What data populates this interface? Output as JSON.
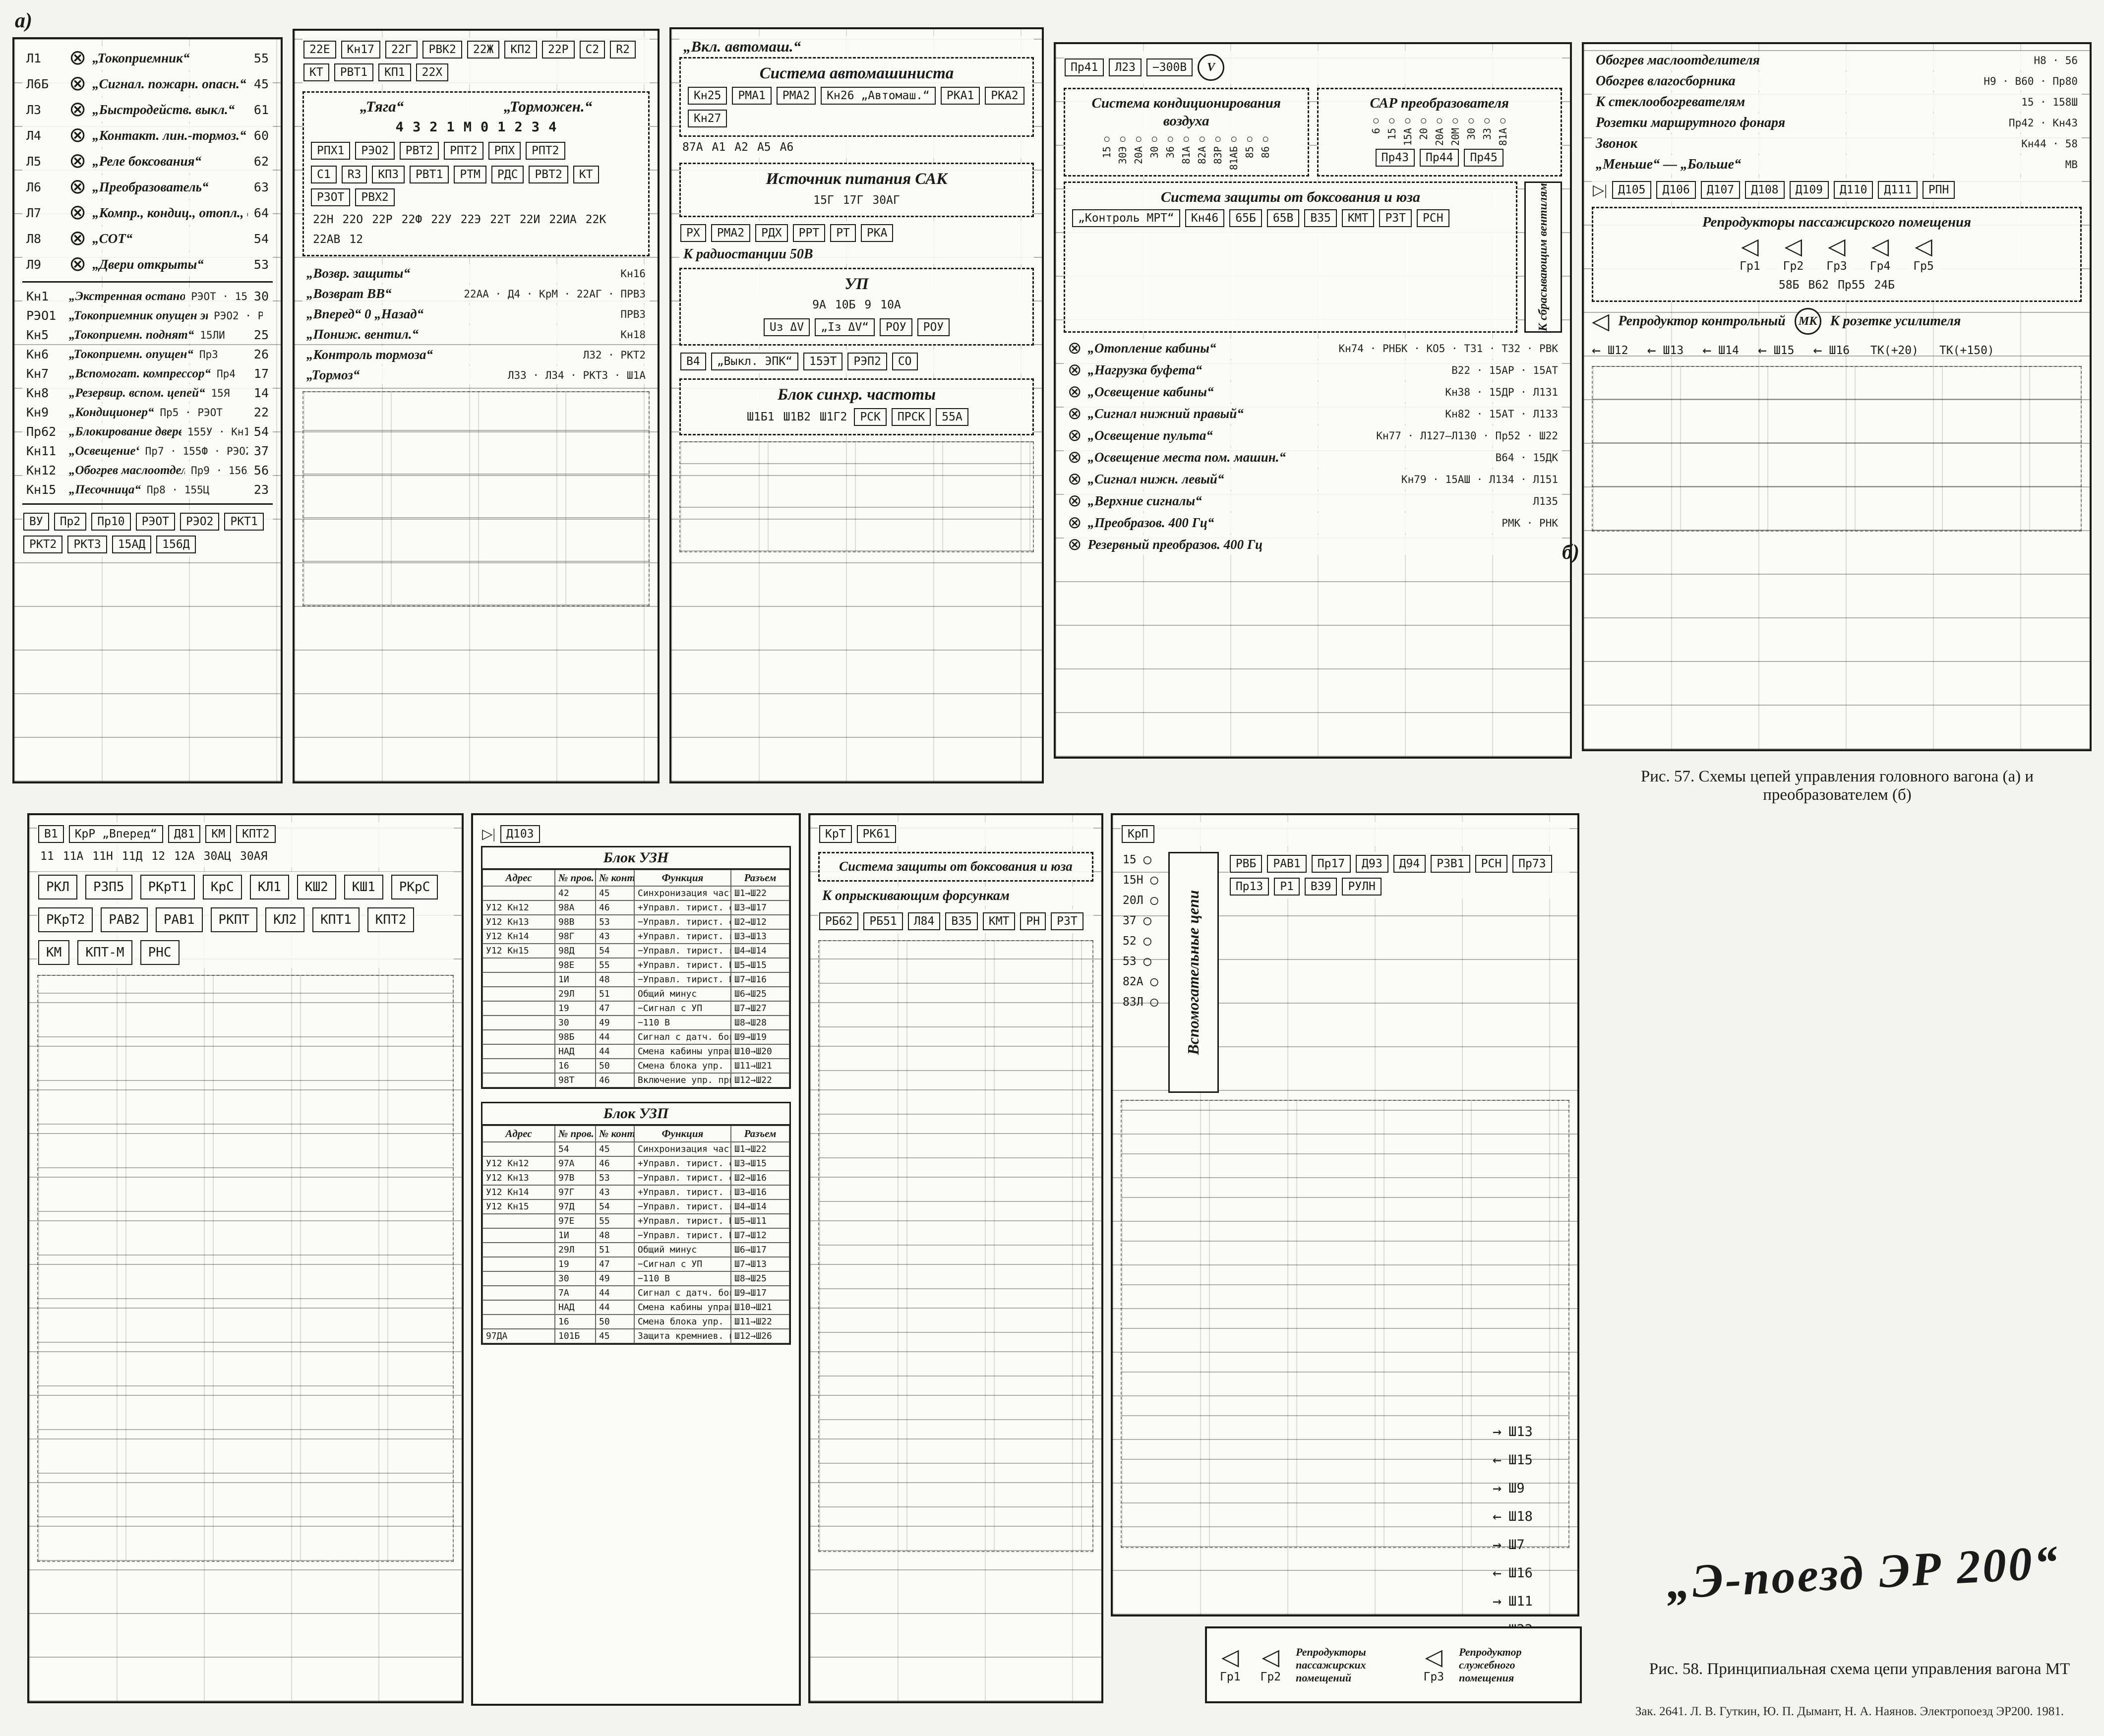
{
  "page": {
    "marker_a": "а)",
    "marker_b": "б)",
    "figure57_caption": "Рис. 57. Схемы цепей управления головного вагона (а) и преобразователем (б)",
    "figure58_caption": "Рис. 58. Принципиальная схема цепи управления вагона МТ",
    "handwriting": "„Э-поезд  ЭР 200“",
    "imprint": "Зак. 2641. Л. В. Гуткин, Ю. П. Дымант, Н. А. Наянов. Электропоезд ЭР200. 1981.",
    "ink_color": "#1a1a1a",
    "paper_color": "#f4f3ed"
  },
  "panelA": {
    "lamps": [
      {
        "id": "Л1",
        "label": "„Токоприемник“",
        "wire": "55"
      },
      {
        "id": "Л6Б",
        "label": "„Сигнал. пожарн. опасн.“",
        "wire": "45"
      },
      {
        "id": "Л3",
        "label": "„Быстродейств. выкл.“",
        "wire": "61"
      },
      {
        "id": "Л4",
        "label": "„Контакт. лин.-тормоз.“",
        "wire": "60"
      },
      {
        "id": "Л5",
        "label": "„Реле боксования“",
        "wire": "62"
      },
      {
        "id": "Л6",
        "label": "„Преобразователь“",
        "wire": "63"
      },
      {
        "id": "Л7",
        "label": "„Компр., кондиц., отопл., вентиляц.“",
        "wire": "64"
      },
      {
        "id": "Л8",
        "label": "„СОТ“",
        "wire": "54"
      },
      {
        "id": "Л9",
        "label": "„Двери открыты“",
        "wire": "53"
      }
    ],
    "switches": [
      {
        "id": "Кн1",
        "label": "„Экстренная остановка“",
        "aux": "РЭОТ · 15БР",
        "wire": "30"
      },
      {
        "id": "РЭО1",
        "label": "„Токоприемник опущен экстренно“",
        "aux": "РЭО2 · РЭОТ",
        "wire": ""
      },
      {
        "id": "Кн5",
        "label": "„Токоприемн. поднят“",
        "aux": "15ЛИ",
        "wire": "25"
      },
      {
        "id": "Кн6",
        "label": "„Токоприемн. опущен“",
        "aux": "Пр3",
        "wire": "26"
      },
      {
        "id": "Кн7",
        "label": "„Вспомогат. компрессор“",
        "aux": "Пр4",
        "wire": "17"
      },
      {
        "id": "Кн8",
        "label": "„Резервир. вспом. цепей“",
        "aux": "15Я",
        "wire": "14"
      },
      {
        "id": "Кн9",
        "label": "„Кондиционер“",
        "aux": "Пр5 · РЭОТ",
        "wire": "22"
      },
      {
        "id": "Пр62",
        "label": "„Блокирование дверей“",
        "aux": "155У · Кн10",
        "wire": "54"
      },
      {
        "id": "Кн11",
        "label": "„Освещение“",
        "aux": "Пр7 · 155Ф · РЭО2",
        "wire": "37"
      },
      {
        "id": "Кн12",
        "label": "„Обогрев маслоотдел.“",
        "aux": "Пр9 · 156Х",
        "wire": "56"
      },
      {
        "id": "Кн15",
        "label": "„Песочница“",
        "aux": "Пр8 · 155Ц",
        "wire": "23"
      }
    ],
    "bottom_components": [
      "ВУ",
      "Пр2",
      "Пр10",
      "РЭОТ",
      "РЭО2",
      "РКТ1",
      "РКТ2",
      "РКТ3",
      "15АД",
      "156Д"
    ]
  },
  "panelB": {
    "top_components": [
      "22Е",
      "Кн17",
      "22Г",
      "РВК2",
      "22Ж",
      "КП2",
      "22Р",
      "С2",
      "R2",
      "КТ",
      "РВТ1",
      "КП1",
      "22Х"
    ],
    "controller": {
      "left_title": "„Тяга“",
      "right_title": "„Торможен.“",
      "positions": [
        "4",
        "3",
        "2",
        "1",
        "М",
        "0",
        "1",
        "2",
        "3",
        "4"
      ],
      "left_contacts": [
        "РПХ1",
        "РЭО2",
        "РВТ2",
        "РПТ2",
        "РПХ",
        "РПТ2"
      ],
      "right_components": [
        "С1",
        "R3",
        "КП3",
        "РВТ1",
        "РТМ",
        "РДС",
        "РВТ2",
        "КТ",
        "РЗОТ",
        "РВХ2"
      ],
      "wires": [
        "22Н",
        "22О",
        "22Р",
        "22Ф",
        "22У",
        "22Э",
        "22Т",
        "22И",
        "22ИА",
        "22К",
        "22АВ",
        "12"
      ]
    },
    "rows": [
      {
        "label": "„Возвр. защиты“",
        "parts": "Кн16"
      },
      {
        "label": "„Возврат ВВ“",
        "parts": "22АА · Д4 · КрМ · 22АГ · ПРВ3"
      },
      {
        "label": "„Вперед“ 0 „Назад“",
        "parts": "ПРВ3"
      },
      {
        "label": "„Пониж. вентил.“",
        "parts": "Кн18"
      },
      {
        "label": "„Контроль тормоза“",
        "parts": "Л32 · РКТ2"
      },
      {
        "label": "„Тормоз“",
        "parts": "Л33 · Л34 · РКТ3 · Ш1А"
      }
    ]
  },
  "panelC": {
    "inlet": "„Вкл. автомаш.“",
    "box_title": "Система автомашиниста",
    "components": [
      "Кн25",
      "РМА1",
      "РМА2",
      "Кн26 „Автомаш.“",
      "РКА1",
      "РКА2",
      "Кн27"
    ],
    "wire_tags": [
      "87А",
      "А1",
      "А2",
      "А5",
      "А6"
    ],
    "source_box": "Источник питания САК",
    "source_wires": [
      "15Г",
      "17Г",
      "30АГ"
    ],
    "mid_components": [
      "РХ",
      "РМА2",
      "РДХ",
      "РРТ",
      "РТ",
      "РКА"
    ],
    "radio_note": "К радиостанции 50В",
    "up_box": "УП",
    "up_pins": [
      "9А",
      "10Б",
      "9",
      "10А"
    ],
    "up_labels": [
      "Uз ΔV",
      "„Iз ΔV“",
      "РОУ",
      "РОУ"
    ],
    "bottom_row": [
      "В4",
      "„Выкл. ЭПК“",
      "15ЭТ",
      "РЭП2",
      "СО"
    ],
    "sync_box": "Блок синхр. частоты",
    "sync_ports": [
      "Ш1Б1",
      "Ш1В2",
      "Ш1Г2"
    ],
    "sync_components": [
      "РСК",
      "ПРСК",
      "55А"
    ]
  },
  "panelD": {
    "top_components": [
      "Пр41",
      "Л23",
      "−300В"
    ],
    "cond_box": "Система кондиционирования воздуха",
    "cond_terminals": [
      "15",
      "30Э",
      "20А",
      "30",
      "36",
      "81А",
      "82А",
      "83Р",
      "81АБ",
      "85",
      "86"
    ],
    "sar_box": "САР преобразователя",
    "sar_terminals": [
      "6",
      "15",
      "15А",
      "20",
      "20А",
      "20М",
      "30",
      "33",
      "81А"
    ],
    "fuses": [
      "Пр43",
      "Пр44",
      "Пр45"
    ],
    "protect_box": "Система защиты от боксования и юза",
    "protect_note": "К сбрасывающим вентилям",
    "protect_components": [
      "„Контроль МРТ“",
      "Кн46",
      "65Б",
      "65В",
      "В35",
      "КМТ",
      "РЗТ",
      "РСН"
    ],
    "light_rows": [
      {
        "label": "„Отопление кабины“",
        "parts": "Кн74 · РНБК · КО5 · Т31 · Т32 · РВК"
      },
      {
        "label": "„Нагрузка буфета“",
        "parts": "В22 · 15АР · 15АТ"
      },
      {
        "label": "„Освещение кабины“",
        "parts": "Кн38 · 15ДР · Л131"
      },
      {
        "label": "„Сигнал нижний правый“",
        "parts": "Кн82 · 15АТ · Л133"
      },
      {
        "label": "„Освещение пульта“",
        "parts": "Кн77 · Л127–Л130 · Пр52 · Ш22"
      },
      {
        "label": "„Освещение места пом. машин.“",
        "parts": "В64 · 15ДК"
      },
      {
        "label": "„Сигнал нижн. левый“",
        "parts": "Кн79 · 15АШ · Л134 · Л151"
      },
      {
        "label": "„Верхние сигналы“",
        "parts": "Л135"
      },
      {
        "label": "„Преобразов. 400 Гц“",
        "parts": "РМК · РНК"
      },
      {
        "label": "Резервный преобразов. 400 Гц",
        "parts": ""
      }
    ]
  },
  "panelE": {
    "rows1": [
      {
        "label": "Обогрев маслоотделителя",
        "parts": "Н8 · 56"
      },
      {
        "label": "Обогрев влагосборника",
        "parts": "Н9 · В60 · Пр80"
      },
      {
        "label": "К стеклообогревателям",
        "parts": "15 · 158Ш"
      },
      {
        "label": "Розетки маршрутного фонаря",
        "parts": "Пр42 · Кн43"
      },
      {
        "label": "Звонок",
        "parts": "Кн44 · 58"
      },
      {
        "label": "„Меньше“ — „Больше“",
        "parts": "МВ"
      }
    ],
    "diodes": [
      "Д105",
      "Д106",
      "Д107",
      "Д108",
      "Д109",
      "Д110",
      "Д111",
      "РПН"
    ],
    "speakers_title": "Репродукторы пассажирского помещения",
    "speakers": [
      "Гр1",
      "Гр2",
      "Гр3",
      "Гр4",
      "Гр5"
    ],
    "speaker_parts": [
      "58Б",
      "В62",
      "Пр55",
      "24Б"
    ],
    "monitor_title": "Репродуктор контрольный",
    "mic": "МК",
    "amp_note": "К розетке усилителя",
    "sh_tags": [
      "Ш12",
      "Ш13",
      "Ш14",
      "Ш15",
      "Ш16"
    ],
    "tk_tags": [
      "ТК(+20)",
      "ТК(+150)"
    ]
  },
  "panelF": {
    "header": [
      "В1",
      "КрР „Вперед“",
      "Д81",
      "КМ",
      "КПТ2"
    ],
    "wires": [
      "11",
      "11А",
      "11Н",
      "11Д",
      "12",
      "12А",
      "30АЦ",
      "30АЯ"
    ],
    "components": [
      "РКЛ",
      "РЗП5",
      "РКрТ1",
      "КрС",
      "КЛ1",
      "КШ2",
      "КШ1",
      "РКрС",
      "РКрТ2",
      "РАВ2",
      "РАВ1",
      "РКПТ",
      "КЛ2",
      "КПТ1",
      "КПТ2",
      "КМ",
      "КПТ-М",
      "РНС"
    ]
  },
  "panelG": {
    "top_components": [
      "Д103"
    ],
    "columns": [
      "Адрес",
      "№ пров.",
      "№ конт.",
      "Функция",
      "Разъем"
    ],
    "table1_title": "Блок УЗН",
    "rows1": [
      {
        "a": "",
        "p": "42",
        "k": "45",
        "f": "Синхронизация частоты",
        "r": "Ш1→Ш22"
      },
      {
        "a": "У12 Кн12",
        "p": "98А",
        "k": "46",
        "f": "+Управл. тирист. отпир.",
        "r": "Ш3→Ш17"
      },
      {
        "a": "У12 Кн13",
        "p": "98В",
        "k": "53",
        "f": "−Управл. тирист. отпир.",
        "r": "Ш2→Ш12"
      },
      {
        "a": "У12 Кн14",
        "p": "98Г",
        "k": "43",
        "f": "+Управл. тирист. гаш.",
        "r": "Ш3→Ш13"
      },
      {
        "a": "У12 Кн15",
        "p": "98Д",
        "k": "54",
        "f": "−Управл. тирист. гаш.",
        "r": "Ш4→Ш14"
      },
      {
        "a": "",
        "p": "98Е",
        "k": "55",
        "f": "+Управл. тирист. КрБ",
        "r": "Ш5→Ш15"
      },
      {
        "a": "",
        "p": "1И",
        "k": "48",
        "f": "−Управл. тирист. КрБ",
        "r": "Ш7→Ш16"
      },
      {
        "a": "",
        "p": "29Л",
        "k": "51",
        "f": "Общий минус",
        "r": "Ш6→Ш25"
      },
      {
        "a": "",
        "p": "19",
        "k": "47",
        "f": "−Сигнал с УП",
        "r": "Ш7→Ш27"
      },
      {
        "a": "",
        "p": "30",
        "k": "49",
        "f": "−110 В",
        "r": "Ш8→Ш28"
      },
      {
        "a": "",
        "p": "98Б",
        "k": "44",
        "f": "Сигнал с датч. боксов.",
        "r": "Ш9→Ш19"
      },
      {
        "a": "",
        "p": "НАД",
        "k": "44",
        "f": "Смена кабины управл.",
        "r": "Ш10→Ш20"
      },
      {
        "a": "",
        "p": "16",
        "k": "50",
        "f": "Смена блока упр. (рез.)",
        "r": "Ш11→Ш21"
      },
      {
        "a": "",
        "p": "98Т",
        "k": "46",
        "f": "Включение упр. приборов",
        "r": "Ш12→Ш22"
      }
    ],
    "table2_title": "Блок УЗП",
    "rows2": [
      {
        "a": "",
        "p": "54",
        "k": "45",
        "f": "Синхронизация частоты",
        "r": "Ш1→Ш22"
      },
      {
        "a": "У12 Кн12",
        "p": "97А",
        "k": "46",
        "f": "+Управл. тирист. отпир.",
        "r": "Ш3→Ш15"
      },
      {
        "a": "У12 Кн13",
        "p": "97В",
        "k": "53",
        "f": "−Управл. тирист. отпир.",
        "r": "Ш2→Ш16"
      },
      {
        "a": "У12 Кн14",
        "p": "97Г",
        "k": "43",
        "f": "+Управл. тирист. гаш.",
        "r": "Ш3→Ш16"
      },
      {
        "a": "У12 Кн15",
        "p": "97Д",
        "k": "54",
        "f": "−Управл. тирист. гаш.",
        "r": "Ш4→Ш14"
      },
      {
        "a": "",
        "p": "97Е",
        "k": "55",
        "f": "+Управл. тирист. КрБ",
        "r": "Ш5→Ш11"
      },
      {
        "a": "",
        "p": "1И",
        "k": "48",
        "f": "−Управл. тирист. КрБ",
        "r": "Ш7→Ш12"
      },
      {
        "a": "",
        "p": "29Л",
        "k": "51",
        "f": "Общий минус",
        "r": "Ш6→Ш17"
      },
      {
        "a": "",
        "p": "19",
        "k": "47",
        "f": "−Сигнал с УП",
        "r": "Ш7→Ш13"
      },
      {
        "a": "",
        "p": "30",
        "k": "49",
        "f": "−110 В",
        "r": "Ш8→Ш25"
      },
      {
        "a": "",
        "p": "7А",
        "k": "44",
        "f": "Сигнал с датч. боксов.",
        "r": "Ш9→Ш17"
      },
      {
        "a": "",
        "p": "НАД",
        "k": "44",
        "f": "Смена кабины управл.",
        "r": "Ш10→Ш21"
      },
      {
        "a": "",
        "p": "16",
        "k": "50",
        "f": "Смена блока упр. (рез.)",
        "r": "Ш11→Ш22"
      },
      {
        "a": "97ДА",
        "p": "101Б",
        "k": "45",
        "f": "Защита кремниев. прибор.",
        "r": "Ш12→Ш26"
      }
    ]
  },
  "panelH": {
    "top": [
      "КрТ",
      "РК61"
    ],
    "box": "Система защиты от боксования и юза",
    "note": "К опрыскивающим форсункам",
    "components": [
      "РБ62",
      "РБ51",
      "Л84",
      "В35",
      "КМТ",
      "РН",
      "РЗТ"
    ]
  },
  "panelI": {
    "top": [
      "КрП"
    ],
    "aux_box": "Вспомогательные цепи",
    "aux_terminals": [
      "15",
      "15Н",
      "20Л",
      "37",
      "52",
      "53",
      "82А",
      "83Л"
    ],
    "components": [
      "РВБ",
      "РАВ1",
      "Пр17",
      "Д93",
      "Д94",
      "РЗВ1",
      "РСН",
      "Пр73",
      "Пр13",
      "Р1",
      "В39",
      "РУЛН"
    ]
  },
  "auxTop": {
    "title": "Вспомогательные цепи",
    "left_box": "Система управления поездом",
    "left_note": "1-68А1 ÷ А7",
    "top_terminals": [
      "85",
      "86"
    ],
    "right_terminals": [
      "И1",
      "И2",
      "И3",
      "И4"
    ],
    "bottom_terminals": [
      "15",
      "15Р",
      "20А",
      "30",
      "37",
      "52",
      "53",
      "81А",
      "82А",
      "83А"
    ]
  },
  "sh_outputs": [
    {
      "dir": "→",
      "tag": "Ш13"
    },
    {
      "dir": "←",
      "tag": "Ш15"
    },
    {
      "dir": "→",
      "tag": "Ш9"
    },
    {
      "dir": "←",
      "tag": "Ш18"
    },
    {
      "dir": "→",
      "tag": "Ш7"
    },
    {
      "dir": "←",
      "tag": "Ш16"
    },
    {
      "dir": "→",
      "tag": "Ш11"
    },
    {
      "dir": "←",
      "tag": "Ш22"
    },
    {
      "dir": "→",
      "tag": "Ш19"
    },
    {
      "dir": "←",
      "tag": "Ш20"
    }
  ],
  "speakers58": {
    "group1_title": "Репродукторы пассажирских помещений",
    "group1": [
      "Гр1",
      "Гр2"
    ],
    "group2_title": "Репродуктор служебного помещения",
    "group2": [
      "Гр3"
    ]
  }
}
